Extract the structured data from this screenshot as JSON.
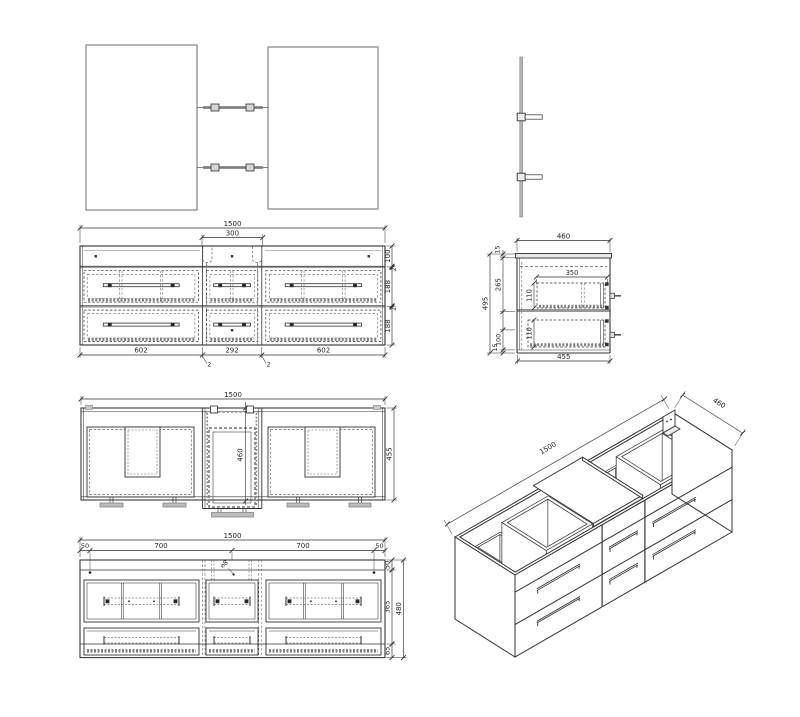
{
  "colors": {
    "line": "#303030",
    "dash": "#5f5f5f",
    "light_gray": "#8c8c8c",
    "foot_gray": "#bdbdbd",
    "slab_gray": "#e8e8e8",
    "hatch": "#808080",
    "background": "#ffffff"
  },
  "views": {
    "front": {
      "overall": "1500",
      "cutout": "300",
      "right_chain": [
        "100",
        "2",
        "188",
        "2",
        "188"
      ],
      "bottom_chain": [
        "602",
        "292",
        "602"
      ],
      "gap_callouts": [
        "2",
        "2"
      ]
    },
    "side": {
      "top": "460",
      "top_thk": "15",
      "height": "495",
      "basin_w": "350",
      "drawer_a": "110",
      "drawer_b": "110",
      "mid": "265",
      "low": "100",
      "bot_thk": "15",
      "bottom": "455"
    },
    "plan": {
      "overall": "1500",
      "center_depth": "460",
      "depth": "455"
    },
    "back": {
      "overall": "1500",
      "top_chain": [
        "50",
        "700",
        "700",
        "50"
      ],
      "right_chain": [
        "50",
        "365",
        "65"
      ],
      "height": "480",
      "hole_callout": "⌀8"
    },
    "iso": {
      "length": "1500",
      "depth": "460"
    }
  }
}
